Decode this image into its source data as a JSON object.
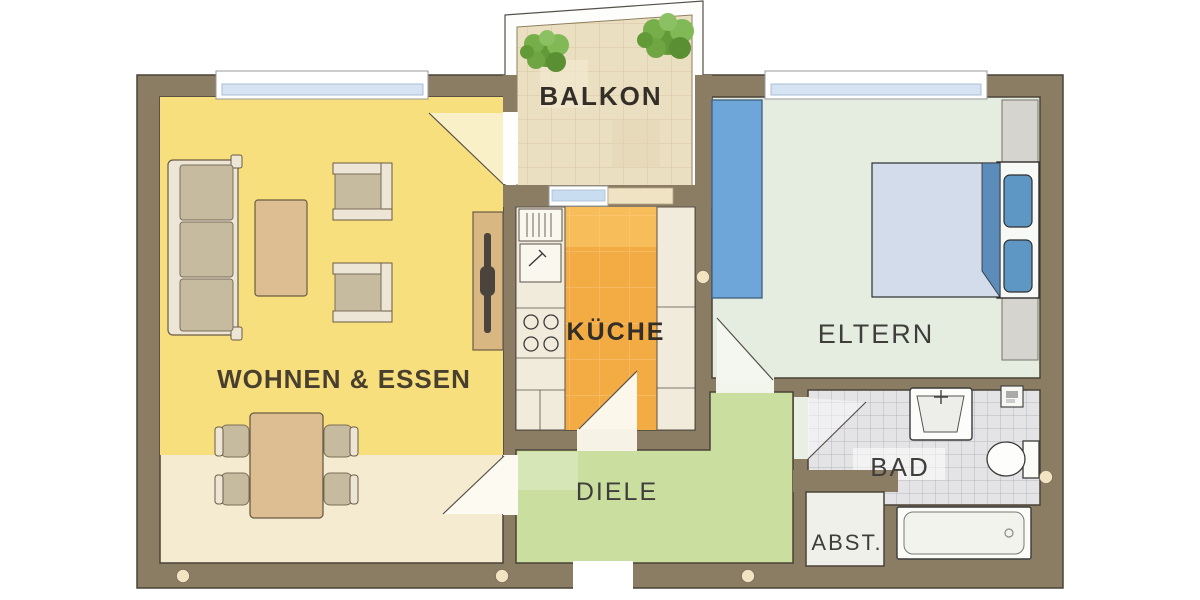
{
  "plan": {
    "type": "apartment-floor-plan",
    "rooms": {
      "balkon": {
        "label": "BALKON"
      },
      "wohnen_essen": {
        "label": "WOHNEN & ESSEN"
      },
      "kueche": {
        "label": "KÜCHE"
      },
      "eltern": {
        "label": "ELTERN"
      },
      "diele": {
        "label": "DIELE"
      },
      "bad": {
        "label": "BAD"
      },
      "abstellraum": {
        "label": "ABST."
      }
    }
  },
  "colors": {
    "wall": "#8B7D64",
    "wohnenUpper": "#F8DF7E",
    "wohnenLower": "#F4EBD1",
    "kitchenCounter": "#F1EBDC",
    "kitchenFloor": "#F3AC44",
    "balconyFloor": "#EBDFC2",
    "elternFloor": "#E4EDE0",
    "dieleFloor": "#C9DE9F",
    "badFloor": "#E4E4E7",
    "abstFloor": "#F0F0EB",
    "wardrobeBlue": "#6FA6DA",
    "pillowBlue": "#5E97C3",
    "blanket": "#D3DCEA",
    "wood": "#DCBE92",
    "cushion": "#C6BB9F",
    "frameCream": "#EDE5D6",
    "plantGreen": "#6FA83F",
    "windowGlass": "#D5E3F2"
  }
}
